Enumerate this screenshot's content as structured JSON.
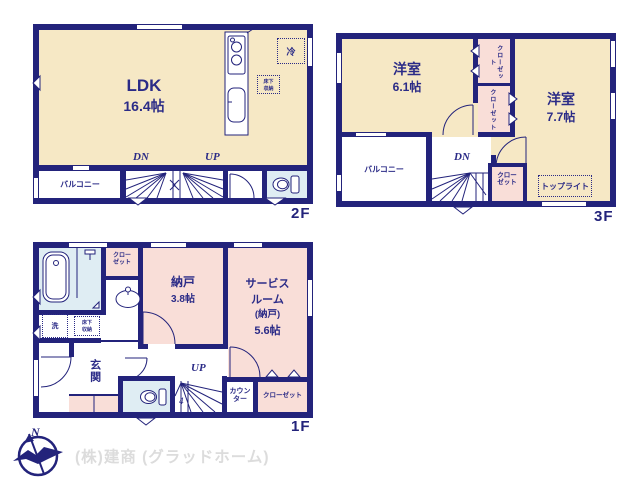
{
  "palette": {
    "wall": "#23237b",
    "text": "#2b2b87",
    "room_cream": "#f6e8c5",
    "room_pink": "#f9ded8",
    "room_blue": "#dfedf3",
    "company_text": "#dcdcdc"
  },
  "floors": {
    "f2": {
      "label": "2F",
      "ldk_name": "LDK",
      "ldk_size": "16.4帖",
      "balcony": "バルコニー",
      "dn": "DN",
      "up": "UP",
      "fridge": "冷",
      "under_floor_storage": "床下収納"
    },
    "f3": {
      "label": "3F",
      "room1_name": "洋室",
      "room1_size": "6.1帖",
      "room2_name": "洋室",
      "room2_size": "7.7帖",
      "closet1": "クローゼット",
      "closet2": "クローゼット",
      "closet3": "クローゼット",
      "balcony": "バルコニー",
      "dn": "DN",
      "skylight": "トップライト"
    },
    "f1": {
      "label": "1F",
      "storage_name": "納戸",
      "storage_size": "3.8帖",
      "service_name_line1": "サービス",
      "service_name_line2": "ルーム",
      "service_name_line3": "(納戸)",
      "service_size": "5.6帖",
      "closet1": "クローゼット",
      "closet2": "クローゼット",
      "laundry": "洗",
      "under_floor_storage": "床下収納",
      "entrance": "玄関",
      "up": "UP",
      "counter": "カウンター",
      "stair_count": "4"
    }
  },
  "footer": {
    "company": "(株)建商 (グラッドホーム)",
    "compass_north": "N"
  }
}
